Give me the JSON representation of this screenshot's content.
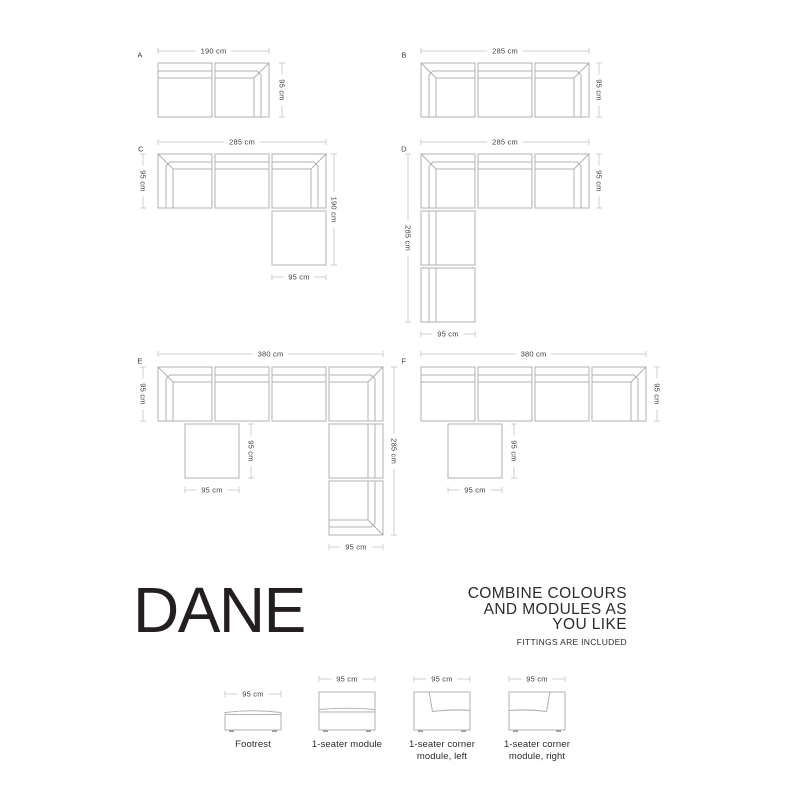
{
  "canvas": {
    "width": 800,
    "height": 800,
    "bg": "#ffffff"
  },
  "style": {
    "module_stroke": "#b0b0b0",
    "dim_stroke": "#cfcfcf",
    "dim_text_color": "#3c3c3c",
    "label_color": "#3c3c3c",
    "heading_color": "#231f20",
    "feet_fill": "#a0a0a0"
  },
  "geometry": {
    "module_px": 54,
    "pitch_px": 57,
    "back_offset_outer": 8,
    "back_offset_inner": 15
  },
  "configs": [
    {
      "label": "A",
      "origin": {
        "x": 158,
        "y": 63
      },
      "label_offset": {
        "x": -18,
        "y": -8
      },
      "modules": [
        {
          "kind": "seat",
          "back": "top",
          "x": 0,
          "y": 0
        },
        {
          "kind": "corner",
          "corner": "tr",
          "x": 57,
          "y": 0
        }
      ],
      "dims": [
        {
          "text": "190 cm",
          "orient": "h",
          "x1": 0,
          "x2": 111,
          "y": -12
        },
        {
          "text": "95 cm",
          "orient": "v",
          "x": 124,
          "y1": 0,
          "y2": 54
        }
      ]
    },
    {
      "label": "B",
      "origin": {
        "x": 421,
        "y": 63
      },
      "label_offset": {
        "x": -17,
        "y": -8
      },
      "modules": [
        {
          "kind": "corner",
          "corner": "tl",
          "x": 0,
          "y": 0
        },
        {
          "kind": "seat",
          "back": "top",
          "x": 57,
          "y": 0
        },
        {
          "kind": "corner",
          "corner": "tr",
          "x": 114,
          "y": 0
        }
      ],
      "dims": [
        {
          "text": "285 cm",
          "orient": "h",
          "x1": 0,
          "x2": 168,
          "y": -12
        },
        {
          "text": "95 cm",
          "orient": "v",
          "x": 178,
          "y1": 0,
          "y2": 54
        }
      ]
    },
    {
      "label": "C",
      "origin": {
        "x": 158,
        "y": 154
      },
      "label_offset": {
        "x": -17,
        "y": -5
      },
      "modules": [
        {
          "kind": "corner",
          "corner": "tl",
          "x": 0,
          "y": 0
        },
        {
          "kind": "seat",
          "back": "top",
          "x": 57,
          "y": 0
        },
        {
          "kind": "corner",
          "corner": "tr",
          "x": 114,
          "y": 0
        },
        {
          "kind": "footrest",
          "x": 114,
          "y": 57
        }
      ],
      "dims": [
        {
          "text": "285 cm",
          "orient": "h",
          "x1": 0,
          "x2": 168,
          "y": -12
        },
        {
          "text": "95 cm",
          "orient": "v",
          "x": -15,
          "y1": 0,
          "y2": 54
        },
        {
          "text": "190 cm",
          "orient": "v",
          "x": 176,
          "y1": 0,
          "y2": 111
        },
        {
          "text": "95 cm",
          "orient": "h",
          "x1": 114,
          "x2": 168,
          "y": 123
        }
      ]
    },
    {
      "label": "D",
      "origin": {
        "x": 421,
        "y": 154
      },
      "label_offset": {
        "x": -17,
        "y": -5
      },
      "modules": [
        {
          "kind": "corner",
          "corner": "tl",
          "x": 0,
          "y": 0
        },
        {
          "kind": "seat",
          "back": "top",
          "x": 57,
          "y": 0
        },
        {
          "kind": "corner",
          "corner": "tr",
          "x": 114,
          "y": 0
        },
        {
          "kind": "seat",
          "back": "left",
          "x": 0,
          "y": 57
        },
        {
          "kind": "seat",
          "back": "left",
          "x": 0,
          "y": 114
        }
      ],
      "dims": [
        {
          "text": "285 cm",
          "orient": "h",
          "x1": 0,
          "x2": 168,
          "y": -12
        },
        {
          "text": "95 cm",
          "orient": "v",
          "x": 178,
          "y1": 0,
          "y2": 54
        },
        {
          "text": "285 cm",
          "orient": "v",
          "x": -13,
          "y1": 0,
          "y2": 168
        },
        {
          "text": "95 cm",
          "orient": "h",
          "x1": 0,
          "x2": 54,
          "y": 180
        }
      ]
    },
    {
      "label": "E",
      "origin": {
        "x": 158,
        "y": 367
      },
      "label_offset": {
        "x": -18,
        "y": -6
      },
      "modules": [
        {
          "kind": "corner",
          "corner": "tl",
          "x": 0,
          "y": 0
        },
        {
          "kind": "seat",
          "back": "top",
          "x": 57,
          "y": 0
        },
        {
          "kind": "seat",
          "back": "top",
          "x": 114,
          "y": 0
        },
        {
          "kind": "corner",
          "corner": "tr",
          "x": 171,
          "y": 0
        },
        {
          "kind": "footrest",
          "x": 27,
          "y": 57
        },
        {
          "kind": "seat",
          "back": "right",
          "x": 171,
          "y": 57
        },
        {
          "kind": "corner",
          "corner": "br",
          "x": 171,
          "y": 114
        }
      ],
      "dims": [
        {
          "text": "380 cm",
          "orient": "h",
          "x1": 0,
          "x2": 225,
          "y": -13
        },
        {
          "text": "95 cm",
          "orient": "v",
          "x": -15,
          "y1": 0,
          "y2": 54
        },
        {
          "text": "95 cm",
          "orient": "v",
          "x": 93,
          "y1": 57,
          "y2": 111
        },
        {
          "text": "95 cm",
          "orient": "h",
          "x1": 27,
          "x2": 81,
          "y": 123
        },
        {
          "text": "285 cm",
          "orient": "v",
          "x": 236,
          "y1": 0,
          "y2": 168
        },
        {
          "text": "95 cm",
          "orient": "h",
          "x1": 171,
          "x2": 225,
          "y": 180
        }
      ]
    },
    {
      "label": "F",
      "origin": {
        "x": 421,
        "y": 367
      },
      "label_offset": {
        "x": -17,
        "y": -6
      },
      "modules": [
        {
          "kind": "seat",
          "back": "top",
          "x": 0,
          "y": 0
        },
        {
          "kind": "seat",
          "back": "top",
          "x": 57,
          "y": 0
        },
        {
          "kind": "seat",
          "back": "top",
          "x": 114,
          "y": 0
        },
        {
          "kind": "corner",
          "corner": "tr",
          "x": 171,
          "y": 0
        },
        {
          "kind": "footrest",
          "x": 27,
          "y": 57
        }
      ],
      "dims": [
        {
          "text": "380 cm",
          "orient": "h",
          "x1": 0,
          "x2": 225,
          "y": -13
        },
        {
          "text": "95 cm",
          "orient": "v",
          "x": 236,
          "y1": 0,
          "y2": 54
        },
        {
          "text": "95 cm",
          "orient": "v",
          "x": 93,
          "y1": 57,
          "y2": 111
        },
        {
          "text": "95 cm",
          "orient": "h",
          "x1": 27,
          "x2": 81,
          "y": 123
        }
      ]
    }
  ],
  "branding": {
    "title": "DANE",
    "headline_lines": [
      "COMBINE COLOURS",
      "AND MODULES AS",
      "YOU LIKE"
    ],
    "subline": "FITTINGS ARE INCLUDED"
  },
  "legend": {
    "items": [
      {
        "name": "footrest",
        "kind": "footrest",
        "dim": "95 cm",
        "dim_y": 694,
        "label_lines": [
          "Footrest"
        ],
        "box": {
          "x": 225,
          "y": 710,
          "w": 56,
          "h": 22
        }
      },
      {
        "name": "one-seater-module",
        "kind": "seater",
        "dim": "95 cm",
        "dim_y": 679,
        "label_lines": [
          "1-seater module"
        ],
        "box": {
          "x": 319,
          "y": 692,
          "w": 56,
          "h": 40
        }
      },
      {
        "name": "one-seater-corner-module-left",
        "kind": "corner-left",
        "dim": "95 cm",
        "dim_y": 679,
        "label_lines": [
          "1-seater corner",
          "module, left"
        ],
        "box": {
          "x": 414,
          "y": 692,
          "w": 56,
          "h": 40
        }
      },
      {
        "name": "one-seater-corner-module-right",
        "kind": "corner-right",
        "dim": "95 cm",
        "dim_y": 679,
        "label_lines": [
          "1-seater corner",
          "module, right"
        ],
        "box": {
          "x": 509,
          "y": 692,
          "w": 56,
          "h": 40
        }
      }
    ]
  }
}
